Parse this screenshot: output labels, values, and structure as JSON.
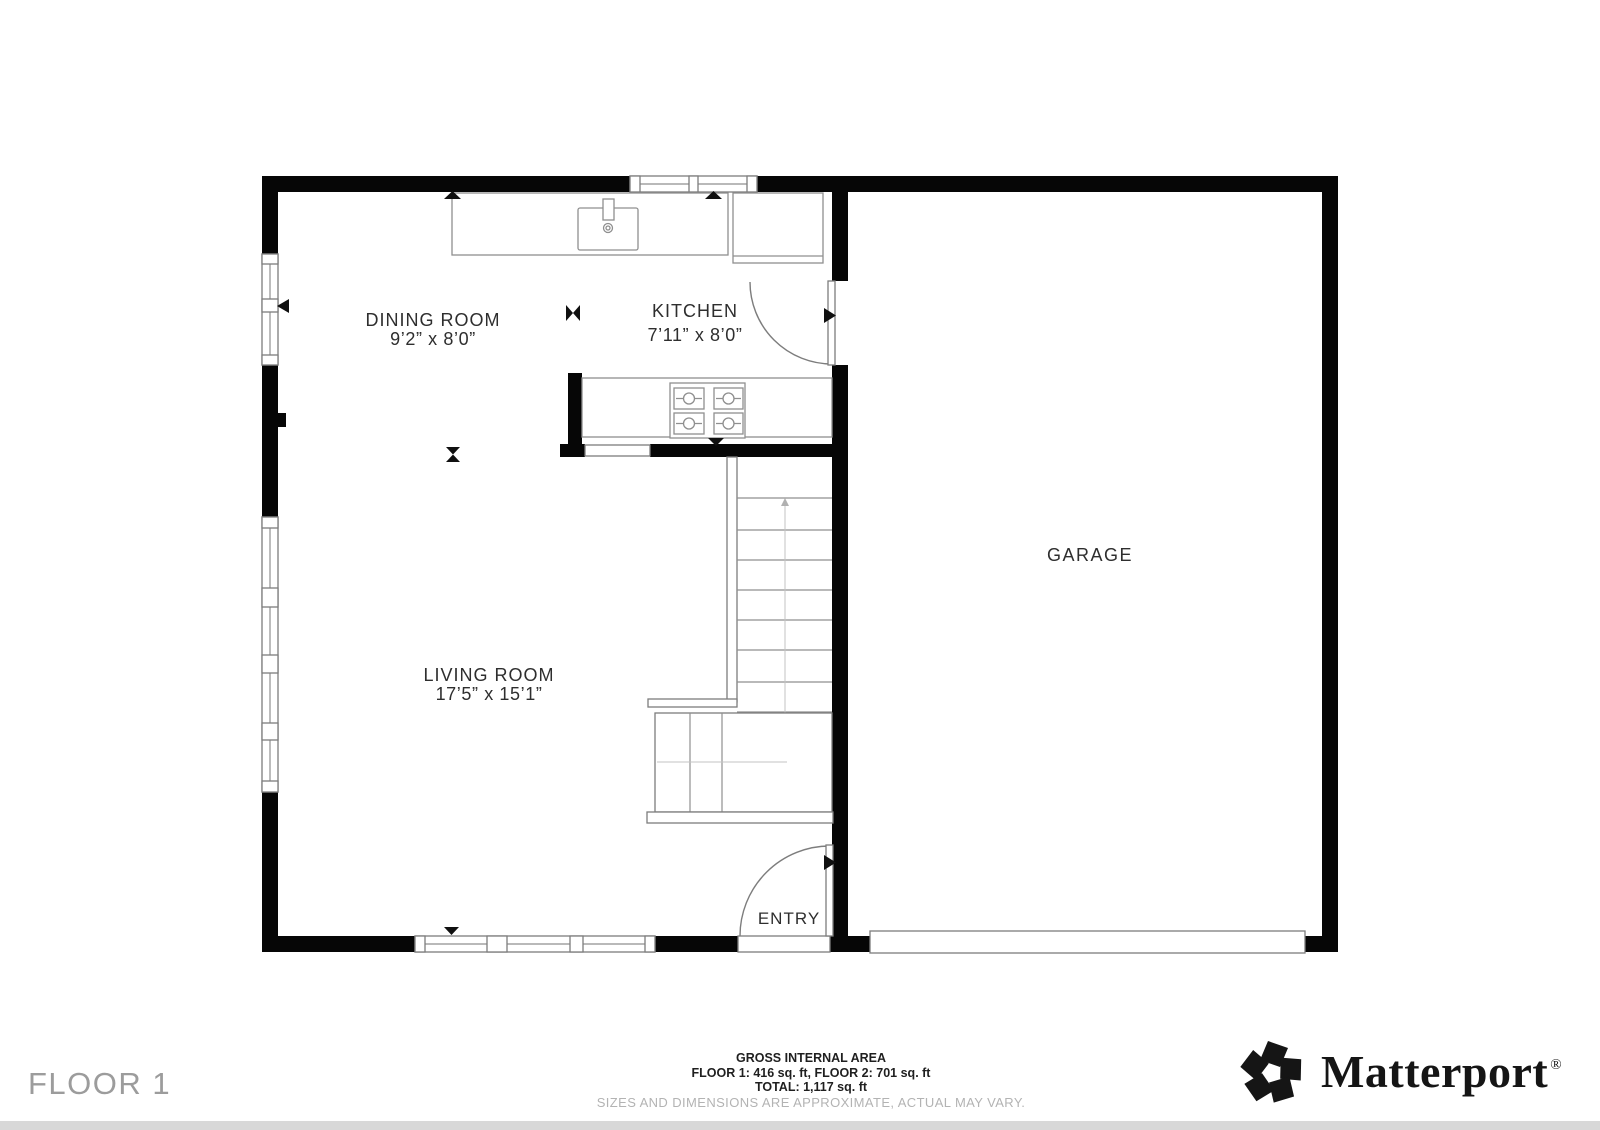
{
  "floor_plan": {
    "rooms": {
      "dining": {
        "name": "DINING ROOM",
        "dims": "9’2” x 8’0”"
      },
      "kitchen": {
        "name": "KITCHEN",
        "dims": "7’11” x 8’0”"
      },
      "living": {
        "name": "LIVING ROOM",
        "dims": "17’5” x 15’1”"
      },
      "garage": {
        "name": "GARAGE"
      },
      "entry": {
        "name": "ENTRY"
      }
    }
  },
  "footer": {
    "floor_label": "FLOOR 1",
    "area": {
      "title": "GROSS INTERNAL AREA",
      "line1": "FLOOR 1: 416 sq. ft, FLOOR 2: 701 sq. ft",
      "line2": "TOTAL: 1,117 sq. ft",
      "disclaimer": "SIZES AND DIMENSIONS ARE APPROXIMATE, ACTUAL MAY VARY."
    },
    "brand": {
      "name": "Matterport",
      "registered": "®"
    }
  },
  "colors": {
    "wall": "#060606",
    "thin_line": "#7d7d7d",
    "label": "#2e2e2e",
    "muted": "#9c9c9c",
    "disclaimer": "#b3b3b3"
  }
}
